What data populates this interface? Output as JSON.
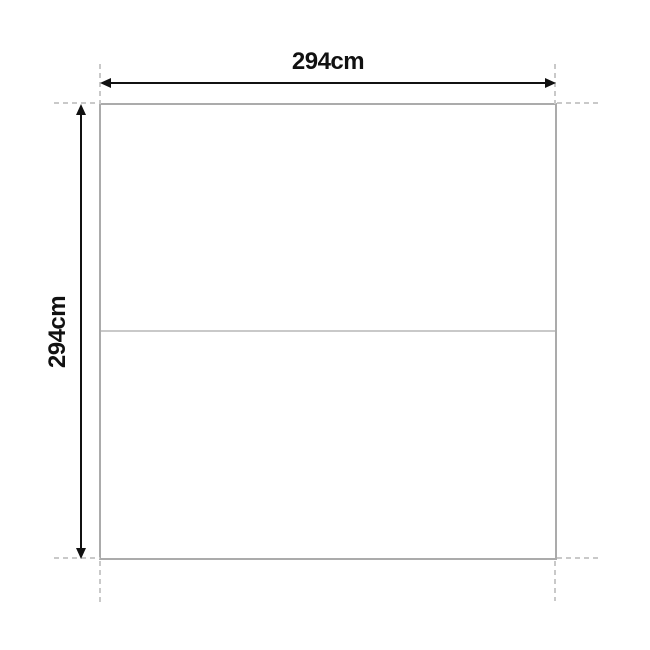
{
  "diagram": {
    "width_label": "294cm",
    "height_label": "294cm"
  },
  "colors": {
    "background": "#ffffff",
    "outline": "#ababab",
    "divider": "#c9c9c9",
    "extension": "#c9c9c9",
    "dimension": "#111111"
  }
}
